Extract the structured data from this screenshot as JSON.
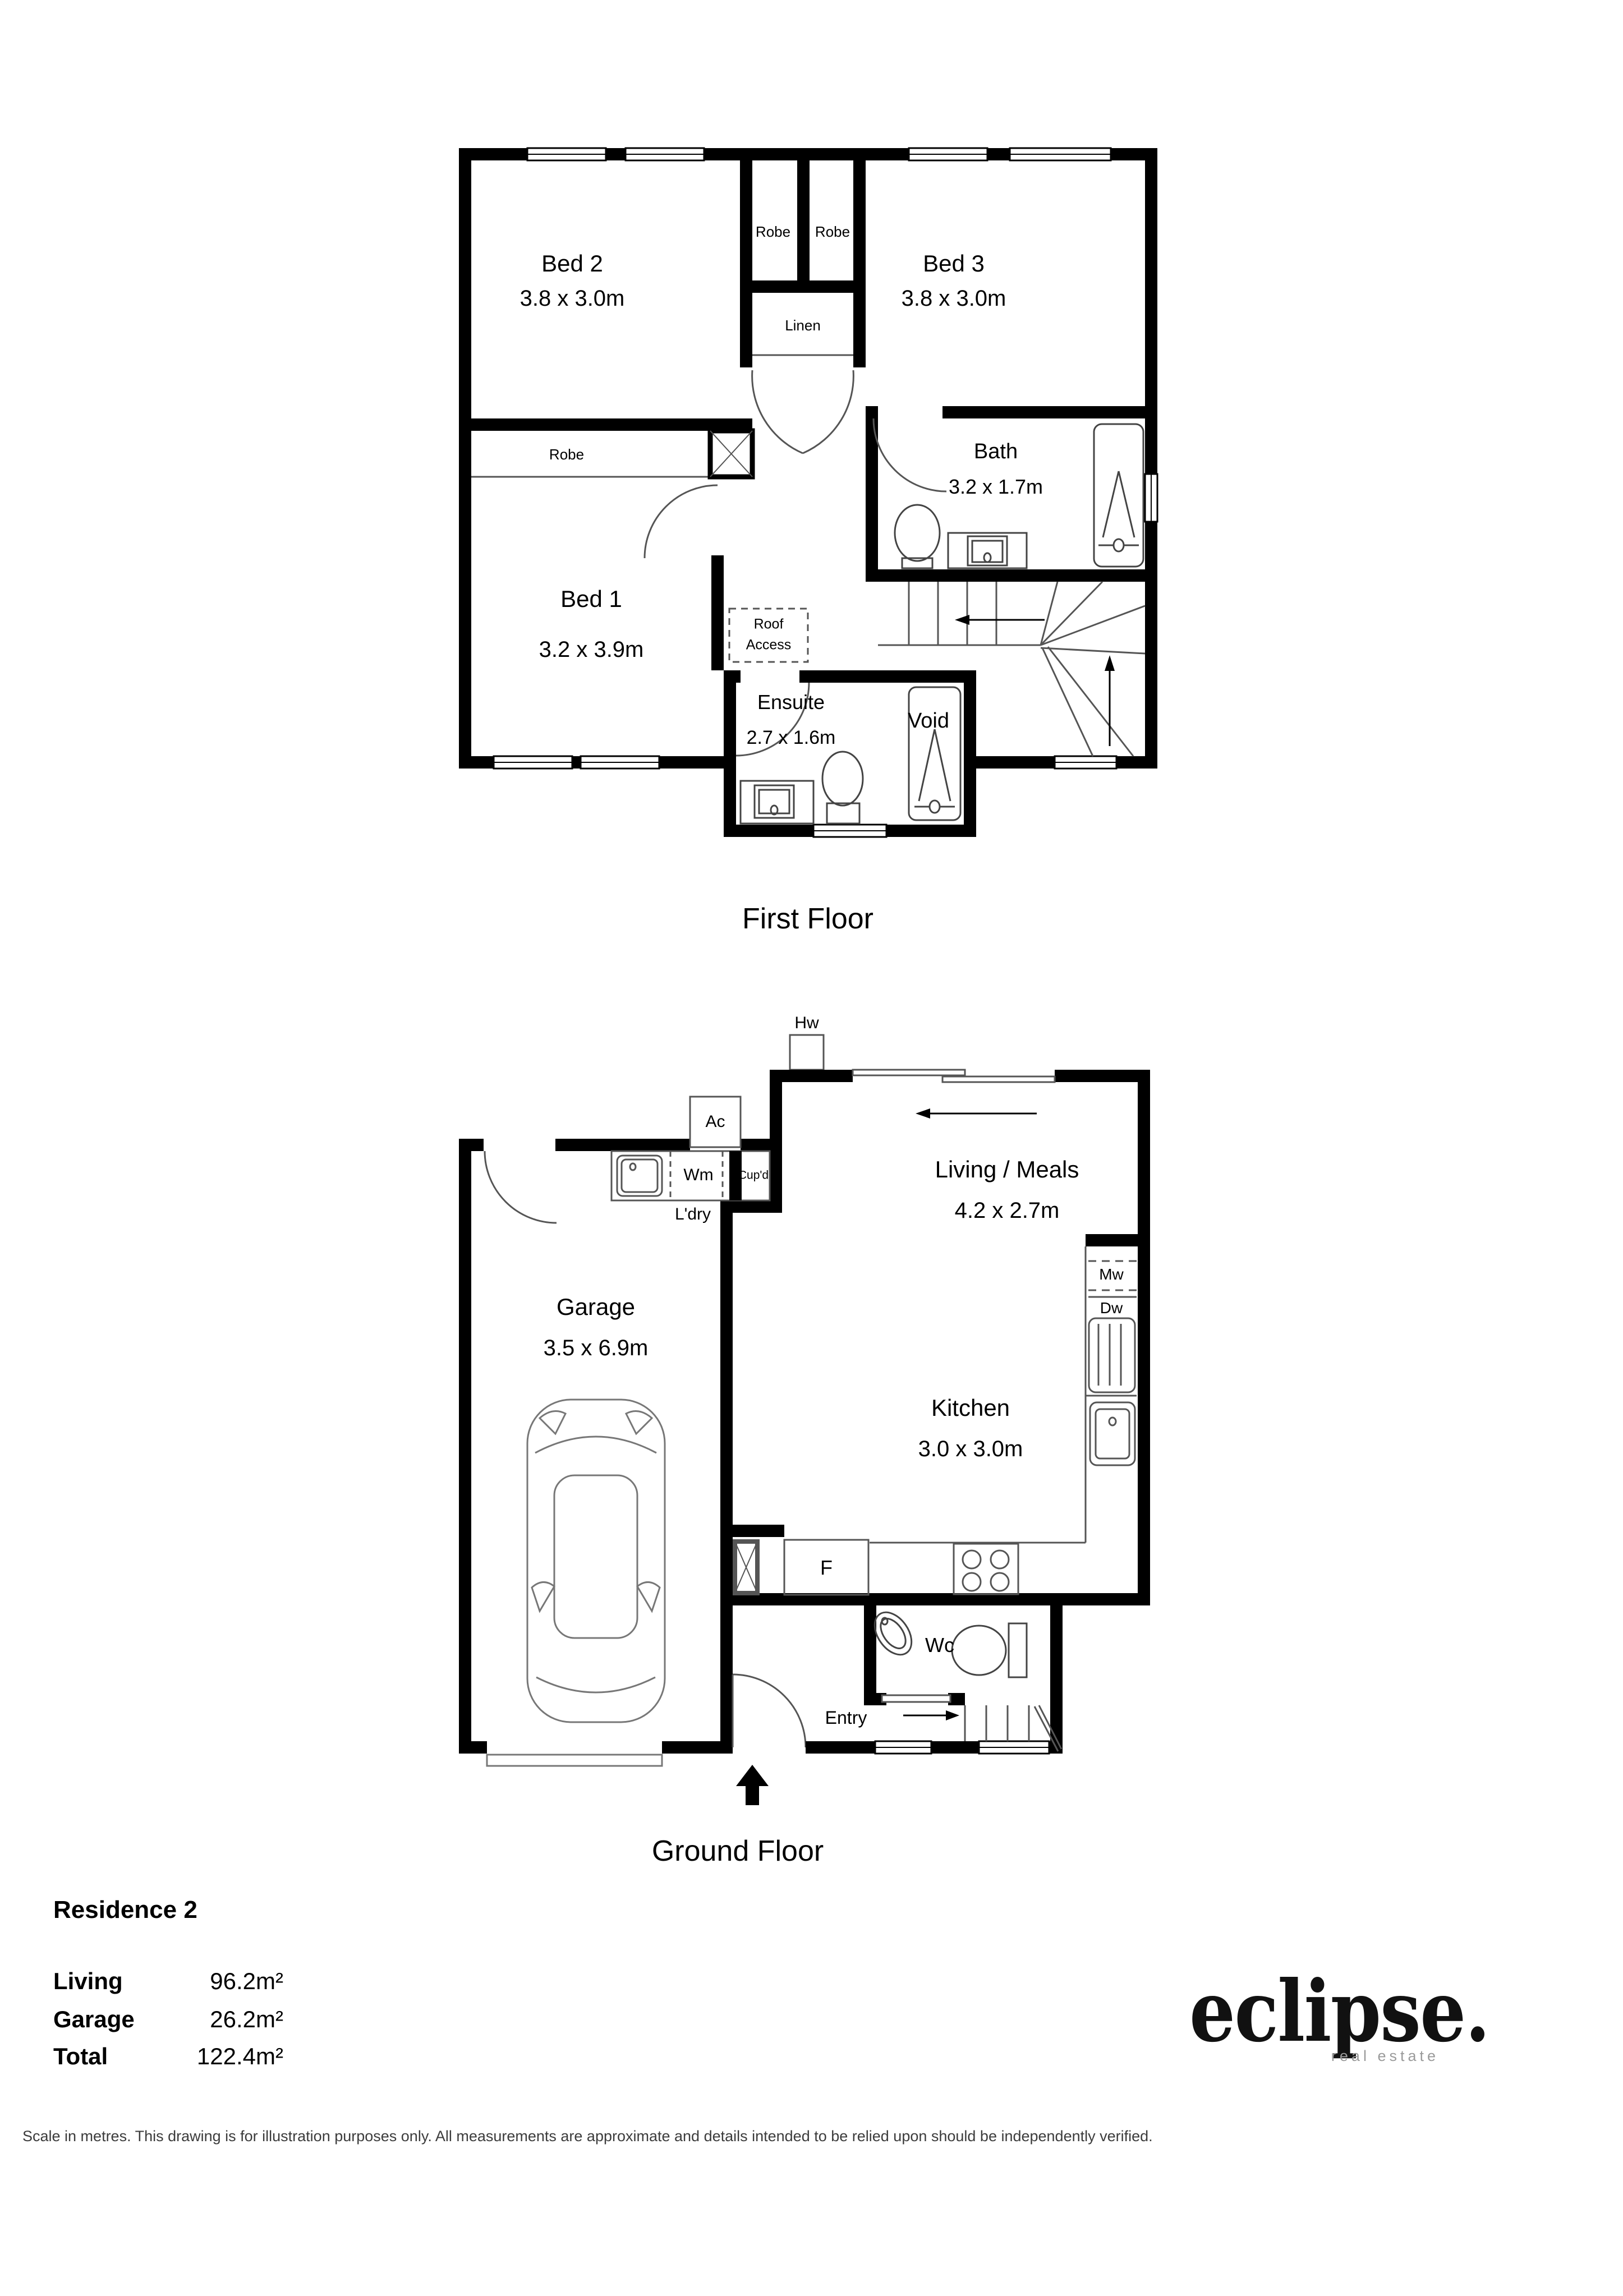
{
  "first_floor": {
    "title": "First Floor",
    "bed1": {
      "name": "Bed 1",
      "dims": "3.2 x 3.9m"
    },
    "bed2": {
      "name": "Bed 2",
      "dims": "3.8 x 3.0m"
    },
    "bed3": {
      "name": "Bed 3",
      "dims": "3.8 x 3.0m"
    },
    "bath": {
      "name": "Bath",
      "dims": "3.2 x 1.7m"
    },
    "ensuite": {
      "name": "Ensuite",
      "dims": "2.7 x 1.6m"
    },
    "robe_bed2": "Robe",
    "robe_bed3": "Robe",
    "robe_bed1": "Robe",
    "linen": "Linen",
    "roof_access_line1": "Roof",
    "roof_access_line2": "Access",
    "void": "Void"
  },
  "ground_floor": {
    "title": "Ground Floor",
    "living": {
      "name": "Living / Meals",
      "dims": "4.2 x 2.7m"
    },
    "kitchen": {
      "name": "Kitchen",
      "dims": "3.0 x 3.0m"
    },
    "garage": {
      "name": "Garage",
      "dims": "3.5 x 6.9m"
    },
    "laundry": "L'dry",
    "hot_water": "Hw",
    "air_con": "Ac",
    "washing_machine": "Wm",
    "cupboard": "Cup'd",
    "microwave": "Mw",
    "dishwasher": "Dw",
    "fridge": "F",
    "wc": "Wc",
    "entry": "Entry"
  },
  "summary": {
    "title": "Residence 2",
    "rows": [
      {
        "label": "Living",
        "value": "96.2m²"
      },
      {
        "label": "Garage",
        "value": "26.2m²"
      },
      {
        "label": "Total",
        "value": "122.4m²"
      }
    ]
  },
  "brand": {
    "logo": "eclipse.",
    "tagline": "real estate"
  },
  "footer": {
    "disclaimer": "Scale in metres. This drawing is for illustration purposes only. All measurements are approximate and details intended to be relied upon should be independently verified."
  }
}
